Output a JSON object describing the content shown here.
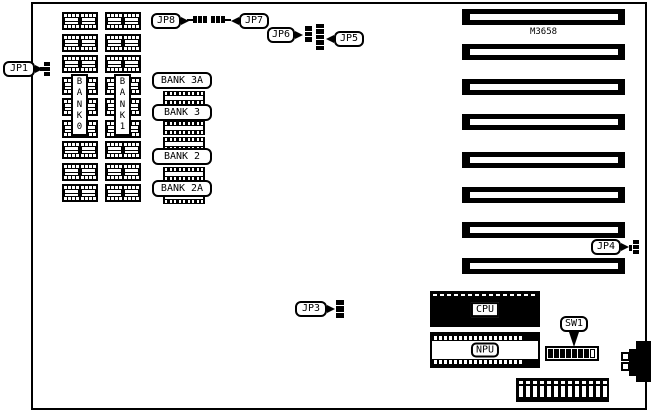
{
  "board": {
    "model_text": "M3658",
    "ink": "#000000",
    "paper": "#ffffff"
  },
  "callouts": {
    "jp1": {
      "label": "JP1"
    },
    "jp3": {
      "label": "JP3"
    },
    "jp4": {
      "label": "JP4"
    },
    "jp5": {
      "label": "JP5"
    },
    "jp6": {
      "label": "JP6"
    },
    "jp7": {
      "label": "JP7"
    },
    "jp8": {
      "label": "JP8"
    },
    "sw1": {
      "label": "SW1"
    }
  },
  "memory": {
    "bank0_letters": [
      "B",
      "A",
      "N",
      "K",
      "0"
    ],
    "bank1_letters": [
      "B",
      "A",
      "N",
      "K",
      "1"
    ],
    "chips_per_column": 9,
    "bank_row_labels": [
      "BANK 3A",
      "BANK 3",
      "BANK 2",
      "BANK 2A"
    ]
  },
  "chips": {
    "cpu_label": "CPU",
    "npu_label": "NPU"
  },
  "expansion_slots": {
    "count": 8
  },
  "dip_switch": {
    "segment_count": 8,
    "dark_segments": 7
  },
  "pin_header": {
    "pin_count": 13
  },
  "npu_socket": {
    "pin_columns": 18
  }
}
